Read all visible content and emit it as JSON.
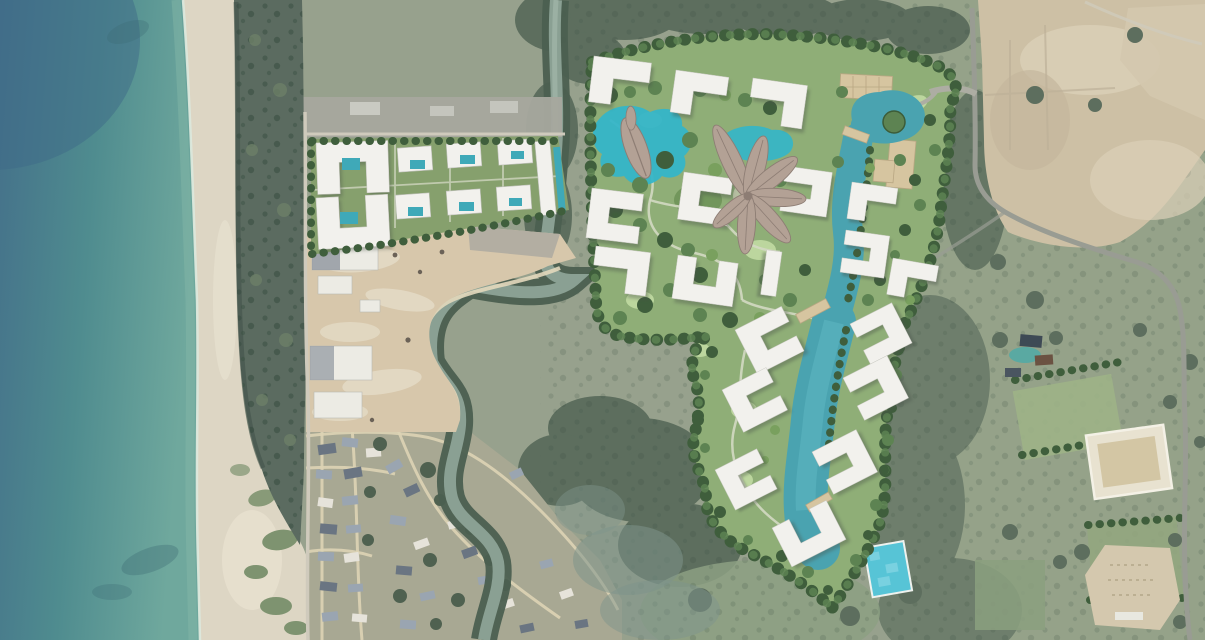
{
  "scene": {
    "title": "Coastal satellite image with resort master-plan rendering overlay",
    "regions": [
      {
        "name": "ocean",
        "label": "sea"
      },
      {
        "name": "beach",
        "label": "sand beach"
      },
      {
        "name": "coastal-tree-belt",
        "label": "shoreline tree belt"
      },
      {
        "name": "coastal-road",
        "label": "coastal road"
      },
      {
        "name": "beachfront-resort",
        "label": "completed beachfront residences with pools"
      },
      {
        "name": "construction-site",
        "label": "construction site"
      },
      {
        "name": "river",
        "label": "winding river"
      },
      {
        "name": "masterplan",
        "label": "rendered master plan",
        "features": [
          "lagoon",
          "leaf-pavilion",
          "flower-pavilion",
          "residential-blocks",
          "central-garden",
          "swimming-pool",
          "entry-plaza",
          "perimeter-trees"
        ]
      },
      {
        "name": "village",
        "label": "village houses"
      },
      {
        "name": "farmland",
        "label": "fields and orchards"
      },
      {
        "name": "cleared-land",
        "label": "cleared tan land"
      },
      {
        "name": "walled-compound",
        "label": "walled compound"
      },
      {
        "name": "sandy-lot",
        "label": "sandy clearing"
      },
      {
        "name": "access-road",
        "label": "paved access road"
      }
    ]
  },
  "colors": {
    "terrain_base": "#97a18d",
    "scrub": "#95a289",
    "forest_dark": "#5d6e5e",
    "forest_mid": "#6e7e6c",
    "field_green": "#9db287",
    "cleared_tan": "#cdc0a5",
    "dirt_light": "#dbd0b8",
    "sandy_patch": "#d4c8ae",
    "road_paved": "#999c93",
    "road_dirt": "#cfcabc",
    "path_sand": "#ddd3b5",
    "path_pale": "#d3d9c2",
    "sea_deep": "#44708a",
    "sea_mid": "#4f8c8f",
    "sea_shallow": "#6fa89d",
    "surf": "#dce8dc",
    "sand": "#ddd6c4",
    "sand_light": "#e9e3d2",
    "coast_trees": "#5b6b60",
    "river_water": "#8aa093",
    "river_bank": "#4b5f50",
    "wetland": "#7e948b",
    "construction": "#d7c7ab",
    "slab_white": "#ecebe4",
    "slab_gray": "#8e959e",
    "rubble": "#b3aea2",
    "plan_lawn": "#8fae77",
    "lawn_light": "#bcd69e",
    "tree_border": "#3f5e3c",
    "tree_mid": "#5d8352",
    "tree_light": "#79a05e",
    "building": "#f2f1ed",
    "building_shadow": "#4a5248",
    "lagoon": "#4aa3b0",
    "lagoon_bright": "#5fb9c4",
    "pond_bright": "#35b5c8",
    "pool_pixel": "#57c4d6",
    "pool_teal": "#3fa9b8",
    "plaza_tan": "#d6c5a0",
    "plaza_line": "#b8a682",
    "petal": "#b3a195",
    "petal_dark": "#8d7d74",
    "village_base": "#a8a893",
    "roof_blue": "#9aa5b1",
    "roof_dark": "#6a7582",
    "roof_white": "#e6e3da",
    "compound_wall": "#e8e2d0",
    "compound_floor": "#d3c6a4"
  }
}
